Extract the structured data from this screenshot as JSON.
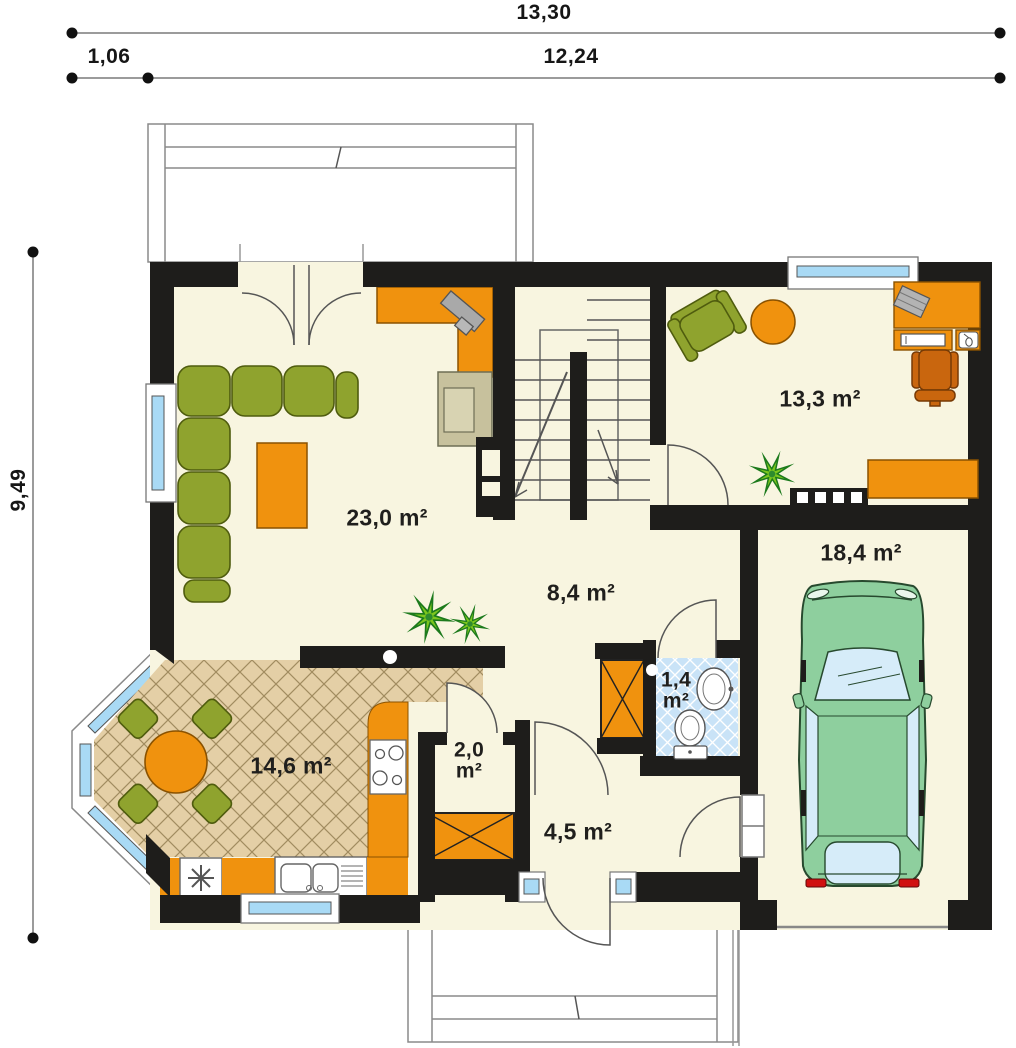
{
  "title": "house-ground-floor-plan",
  "dimensions": {
    "width_total": "13,30",
    "width_offset": "1,06",
    "width_main": "12,24",
    "height_total": "9,49"
  },
  "rooms": [
    {
      "id": "living-room",
      "area": "23,0 m²"
    },
    {
      "id": "office-bedroom",
      "area": "13,3 m²"
    },
    {
      "id": "garage",
      "area": "18,4 m²"
    },
    {
      "id": "hall",
      "area": "8,4 m²"
    },
    {
      "id": "wc",
      "area": "1,4\nm²"
    },
    {
      "id": "kitchen-dining",
      "area": "14,6 m²"
    },
    {
      "id": "pantry",
      "area": "2,0\nm²"
    },
    {
      "id": "entry",
      "area": "4,5 m²"
    }
  ],
  "colors": {
    "wall": "#1e1d1b",
    "floor_cream": "#f8f5e0",
    "furniture_orange": "#f0920e",
    "furniture_green": "#8fa32e",
    "kitchen_tile": "#e4cfa6",
    "wc_tile": "#c9e3f7",
    "window_glass": "#a9daf5",
    "car_green": "#8ecf9e",
    "taillight_red": "#d01010"
  }
}
